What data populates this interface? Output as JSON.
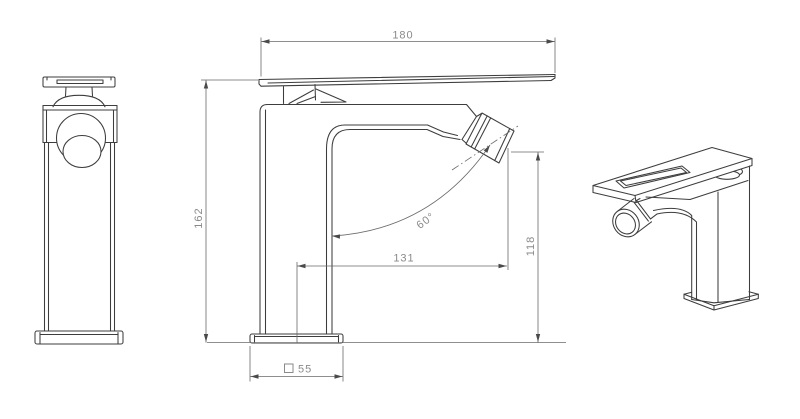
{
  "drawing": {
    "type": "technical-drawing",
    "subject": "single-lever mixer faucet, three views (side elevation, front elevation with dimensions, perspective)",
    "dimensions": {
      "overall_width": {
        "value": "180",
        "orientation": "horizontal"
      },
      "overall_height": {
        "value": "162",
        "orientation": "vertical"
      },
      "spout_reach": {
        "value": "131",
        "orientation": "horizontal"
      },
      "spout_outlet_height": {
        "value": "118",
        "orientation": "vertical"
      },
      "spout_angle": {
        "value": "60°",
        "orientation": "angular"
      },
      "base_section": {
        "value": "55",
        "symbol": "square-section"
      }
    },
    "colors": {
      "background": "#ffffff",
      "geometry_line": "#3d3d3d",
      "dimension_line": "#6a6a6a",
      "dimension_text": "#8a8a8a"
    }
  }
}
